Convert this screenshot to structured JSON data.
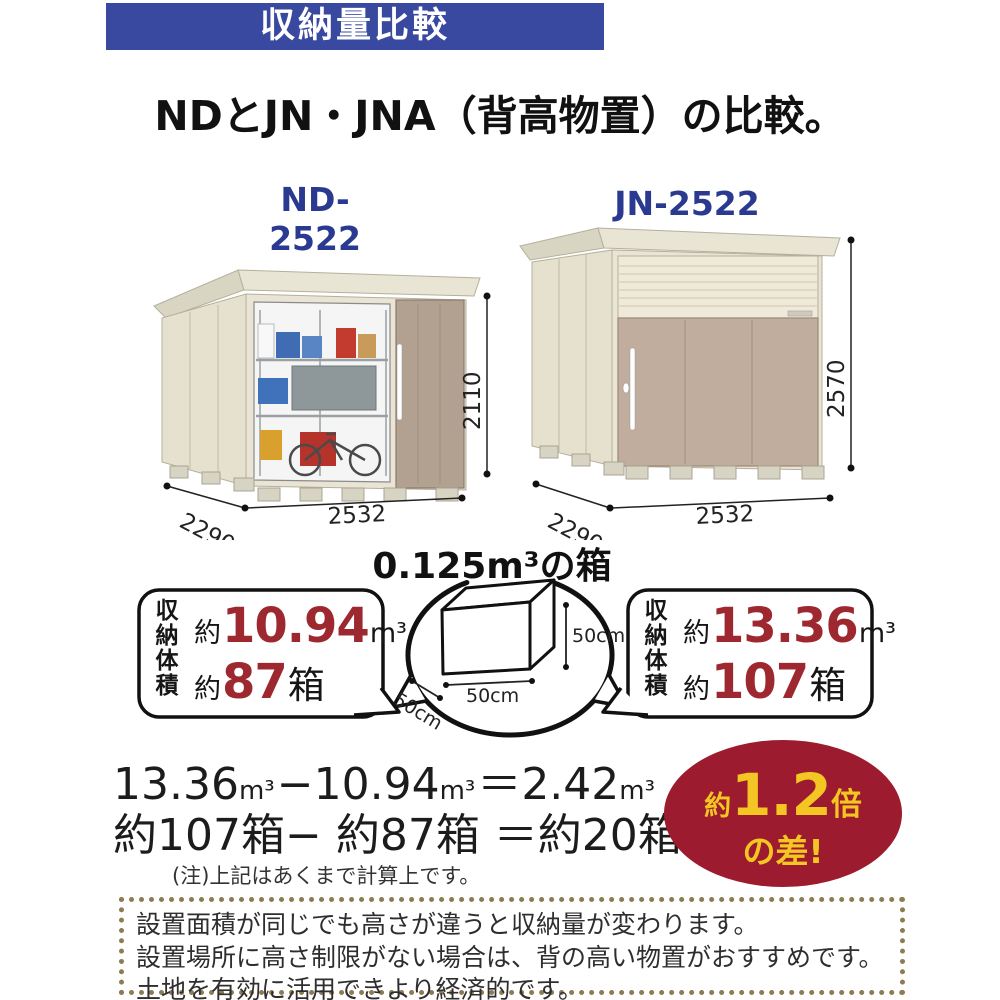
{
  "banner": {
    "text": "収納量比較"
  },
  "title": {
    "text": "NDとJN・JNA（背高物置）の比較。"
  },
  "sheds": {
    "left": {
      "model": "ND-2522",
      "width": "2532",
      "depth": "2290",
      "height": "2110"
    },
    "right": {
      "model": "JN-2522",
      "width": "2532",
      "depth": "2290",
      "height": "2570"
    }
  },
  "cube": {
    "title": "0.125m³の箱",
    "height": "50cm",
    "width": "50cm",
    "depth": "50cm"
  },
  "capacity": {
    "label": "収納体積",
    "left": {
      "approx": "約",
      "volume": "10.94",
      "volume_unit": "m³",
      "approx2": "約",
      "boxes": "87",
      "boxes_unit": "箱"
    },
    "right": {
      "approx": "約",
      "volume": "13.36",
      "volume_unit": "m³",
      "approx2": "約",
      "boxes": "107",
      "boxes_unit": "箱"
    }
  },
  "formula": {
    "volume": {
      "v1": "13.36",
      "u1": "m³",
      "minus": "−",
      "v2": "10.94",
      "u2": "m³",
      "equals": "＝",
      "v3": "2.42",
      "u3": "m³"
    },
    "boxes": "約107箱− 約87箱 ＝約20箱",
    "note": "(注)上記はあくまで計算上です。"
  },
  "badge": {
    "prefix": "約",
    "value": "1.2",
    "suffix": "倍",
    "line2": "の差!"
  },
  "footer": {
    "lines": [
      "設置面積が同じでも高さが違うと収納量が変わります。",
      "設置場所に高さ制限がない場合は、背の高い物置がおすすめです。",
      "土地を有効に活用できより経済的です。"
    ]
  },
  "colors": {
    "banner_bg": "#3949a0",
    "accent_red": "#9e2830",
    "badge_bg": "#9c1b2e",
    "badge_text": "#f3c623",
    "wall_cream": "#e9e4d4",
    "door_tan": "#b2a090",
    "door_tan_right": "#c1ad9d",
    "dotted_border": "#8d7c52",
    "model_blue": "#293a90"
  }
}
